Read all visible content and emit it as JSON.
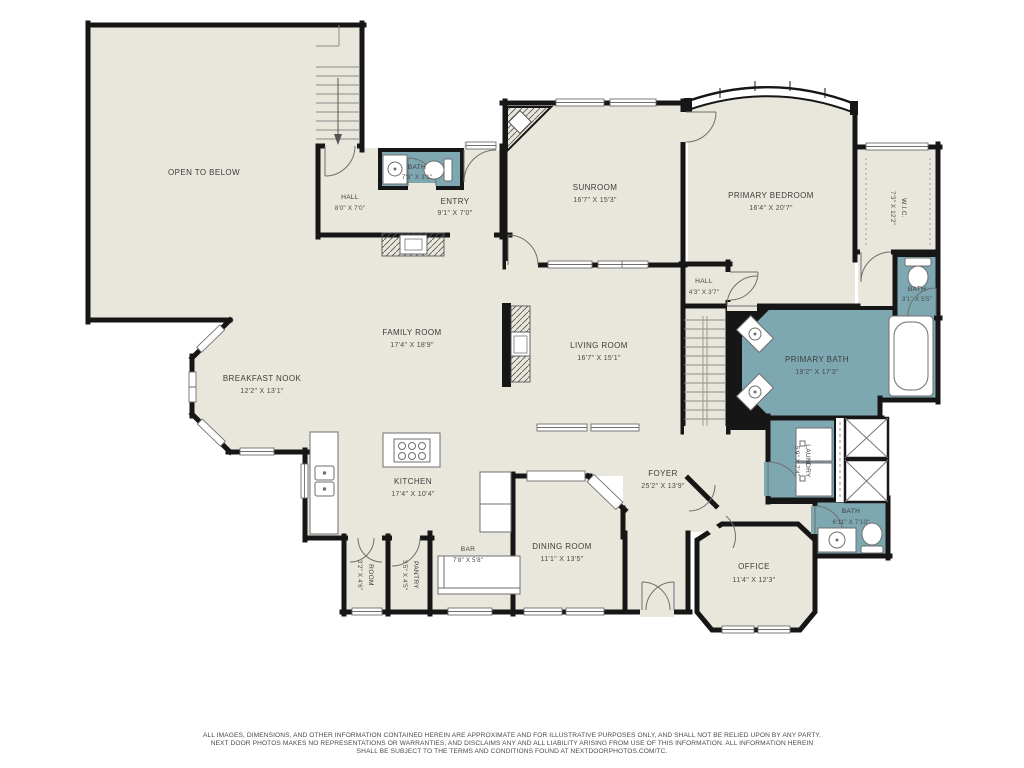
{
  "colors": {
    "floor": "#e9e6dc",
    "wet_room": "#7da7b1",
    "wall": "#161616",
    "fixture_line": "#777777",
    "label": "#3c3c3c"
  },
  "rooms": {
    "open_to_below": {
      "name": "OPEN TO BELOW",
      "dims": ""
    },
    "hall_upper": {
      "name": "HALL",
      "dims": "8'0\" X 7'0\""
    },
    "bath_entry": {
      "name": "BATH",
      "dims": "7'3\" X 3'1\""
    },
    "entry": {
      "name": "ENTRY",
      "dims": "9'1\" X 7'0\""
    },
    "sunroom": {
      "name": "SUNROOM",
      "dims": "16'7\" X 15'3\""
    },
    "primary_bedroom": {
      "name": "PRIMARY BEDROOM",
      "dims": "16'4\" X 20'7\""
    },
    "wic": {
      "name": "W.I.C.",
      "dims": "7'3\" X 12'2\""
    },
    "bath_wic": {
      "name": "BATH",
      "dims": "3'1\" X 5'5\""
    },
    "hall": {
      "name": "HALL",
      "dims": "4'3\" X 3'7\""
    },
    "family_room": {
      "name": "FAMILY ROOM",
      "dims": "17'4\" X 18'9\""
    },
    "living_room": {
      "name": "LIVING ROOM",
      "dims": "16'7\" X 15'1\""
    },
    "breakfast_nook": {
      "name": "BREAKFAST NOOK",
      "dims": "12'2\" X 13'1\""
    },
    "primary_bath": {
      "name": "PRIMARY BATH",
      "dims": "19'2\" X 17'3\""
    },
    "kitchen": {
      "name": "KITCHEN",
      "dims": "17'4\" X 10'4\""
    },
    "bar": {
      "name": "BAR",
      "dims": "7'8\" X 5'8\""
    },
    "pantry": {
      "name": "PANTRY",
      "dims": "3'5\" X 4'5\""
    },
    "room": {
      "name": "ROOM",
      "dims": "3'2\" X 4'6\""
    },
    "foyer": {
      "name": "FOYER",
      "dims": "25'2\" X 13'9\""
    },
    "dining_room": {
      "name": "DINING ROOM",
      "dims": "11'1\" X 13'5\""
    },
    "office": {
      "name": "OFFICE",
      "dims": "11'4\" X 12'3\""
    },
    "laundry": {
      "name": "LAUNDRY",
      "dims": "5'9\" X 7'4\""
    },
    "bath_office": {
      "name": "BATH",
      "dims": "6'11\" X 7'10\""
    }
  },
  "disclaimer": {
    "line1": "ALL IMAGES, DIMENSIONS, AND OTHER INFORMATION CONTAINED HEREIN ARE APPROXIMATE AND FOR ILLUSTRATIVE PURPOSES ONLY, AND SHALL NOT BE RELIED UPON BY ANY PARTY.",
    "line2": "NEXT DOOR PHOTOS MAKES NO REPRESENTATIONS OR WARRANTIES, AND DISCLAIMS ANY AND ALL LIABILITY ARISING FROM USE OF THIS INFORMATION. ALL INFORMATION HEREIN",
    "line3": "SHALL BE SUBJECT TO THE TERMS AND CONDITIONS FOUND AT NEXTDOORPHOTOS.COM/TC."
  }
}
